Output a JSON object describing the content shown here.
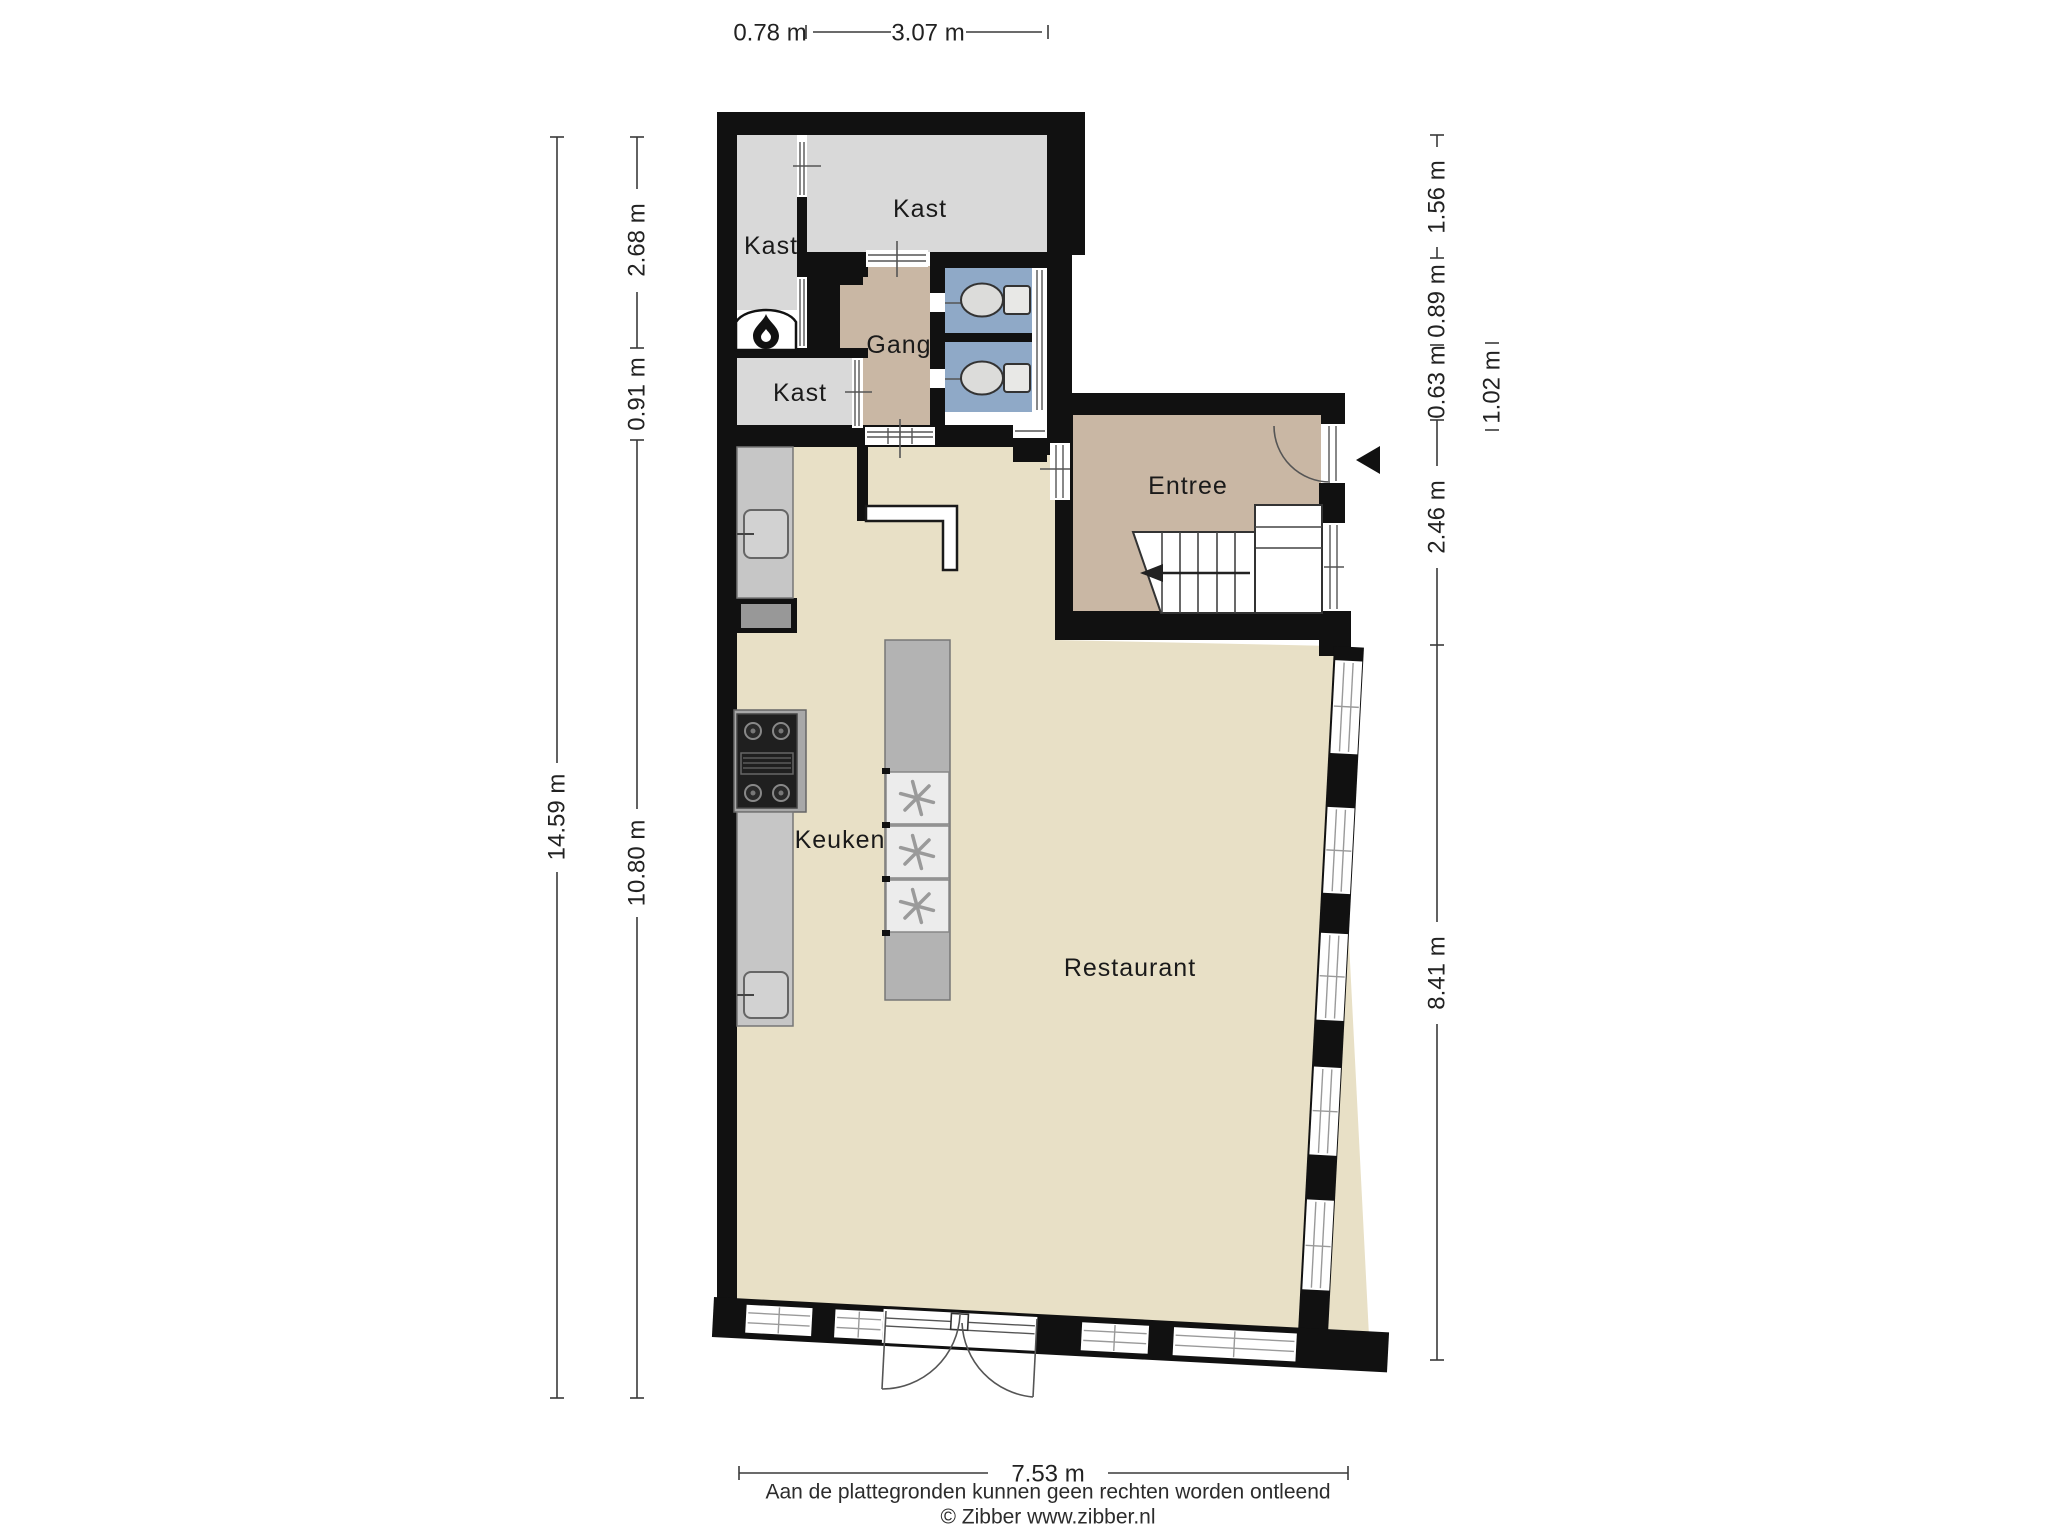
{
  "rooms": [
    {
      "id": "kast-top-left",
      "label": "Kast"
    },
    {
      "id": "kast-top",
      "label": "Kast"
    },
    {
      "id": "kast-lower",
      "label": "Kast"
    },
    {
      "id": "gang",
      "label": "Gang"
    },
    {
      "id": "entree",
      "label": "Entree"
    },
    {
      "id": "keuken",
      "label": "Keuken"
    },
    {
      "id": "restaurant",
      "label": "Restaurant"
    }
  ],
  "dimensions": {
    "top": [
      "0.78 m",
      "3.07 m"
    ],
    "left_outer": "14.59 m",
    "left_inner": [
      "2.68 m",
      "0.91 m",
      "10.80 m"
    ],
    "right_inner": [
      "1.56 m",
      "0.89 m",
      "0.63 m",
      "2.46 m",
      "8.41 m"
    ],
    "right_outer": "1.02 m",
    "bottom": "7.53 m"
  },
  "footer": {
    "disclaimer": "Aan de plattegronden kunnen geen rechten worden ontleend",
    "copyright": "© Zibber www.zibber.nl"
  },
  "colors": {
    "wall": "#111111",
    "floor_closet": "#d9d9d9",
    "floor_hall": "#c9b7a4",
    "floor_toilet": "#8fa9c7",
    "floor_main": "#e8e0c6",
    "counter": "#c6c6c6",
    "island": "#b3b3b3"
  },
  "icons": {
    "fireplace": "flame-icon",
    "entrance": "entrance-arrow-icon",
    "stairs": "stairs-direction-arrow-icon",
    "appliance": "asterisk-appliance-icon"
  }
}
